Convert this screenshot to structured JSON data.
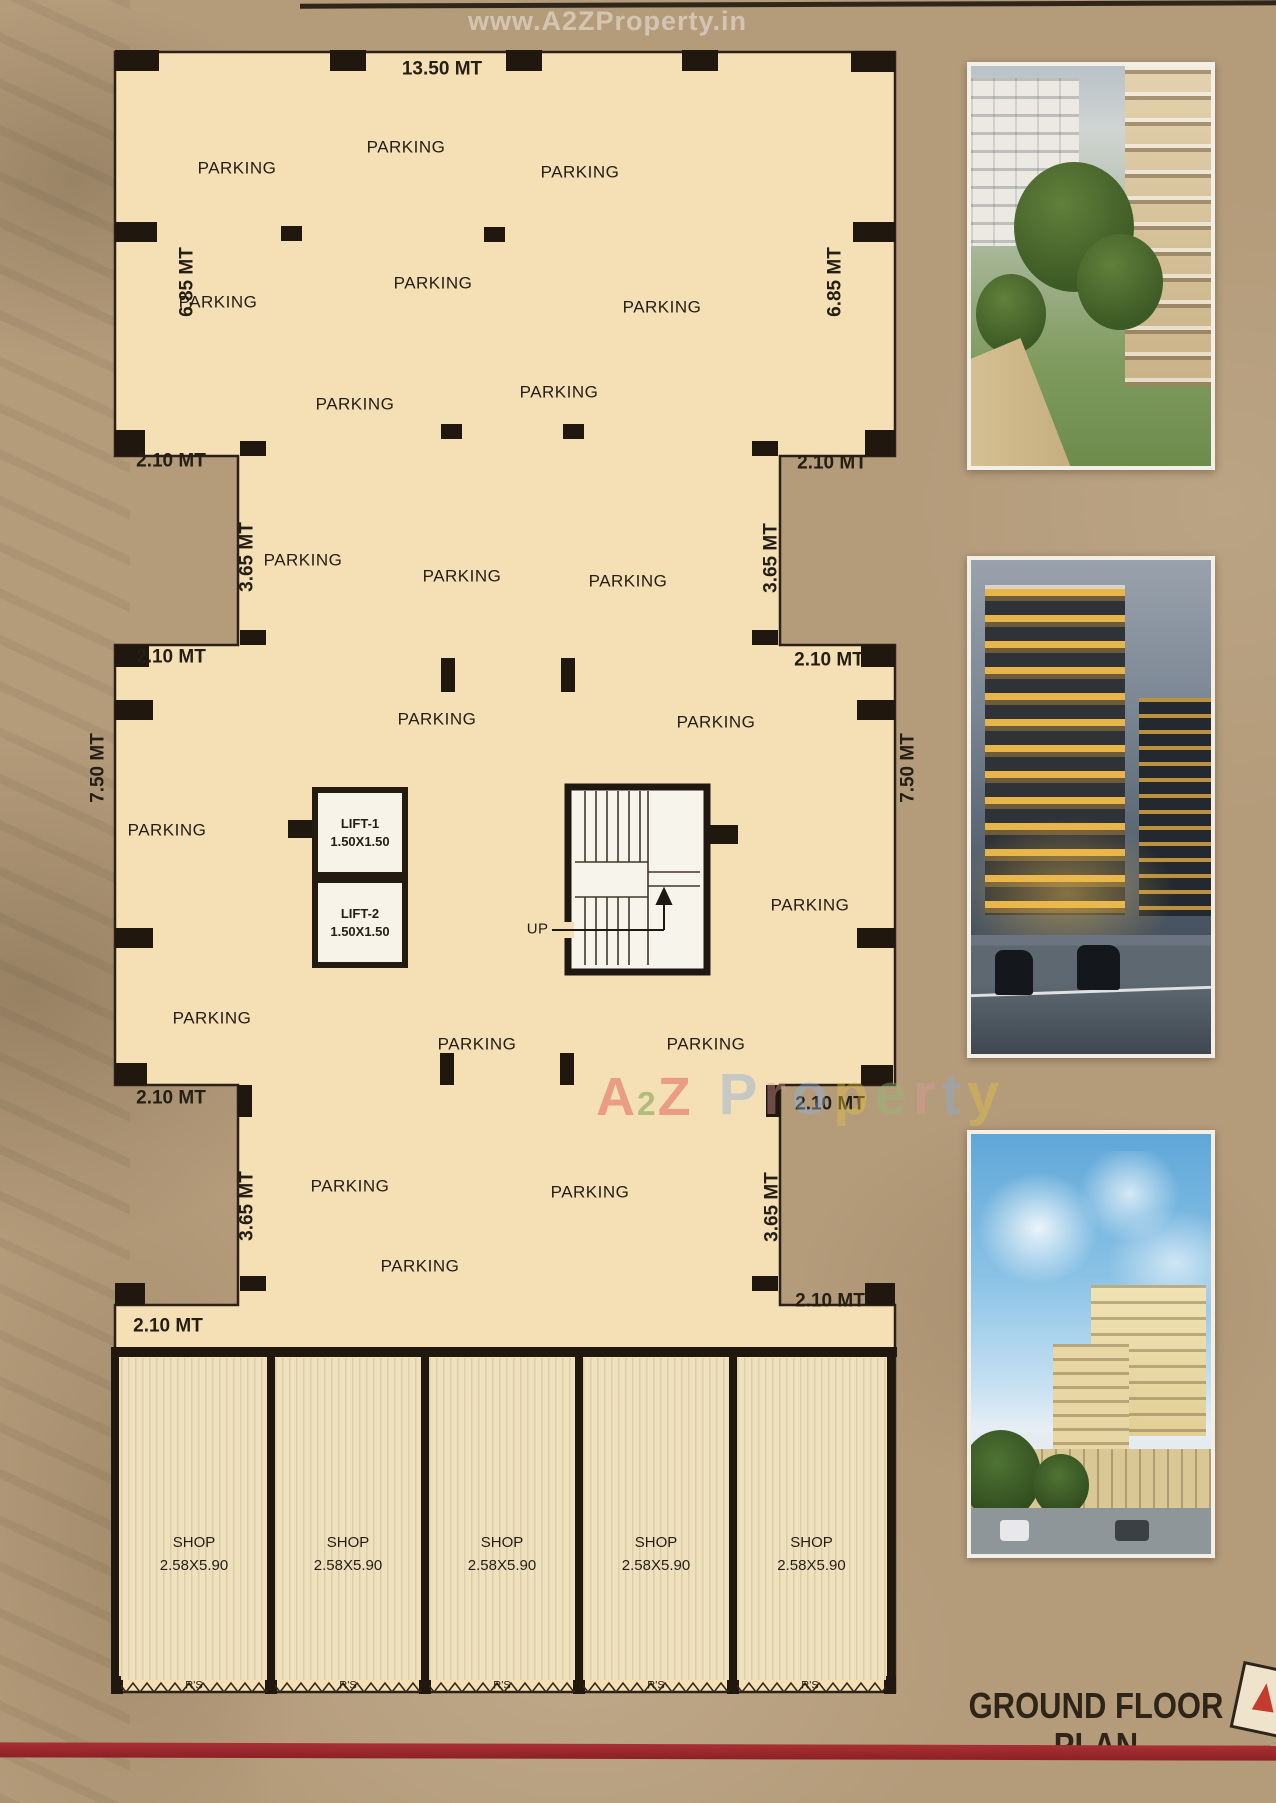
{
  "page": {
    "background": "#b49c7b",
    "accent_red": "#9c2a2d"
  },
  "watermarks": {
    "top_url": "www.A2ZProperty.in",
    "a2z_letters": [
      {
        "ch": "A",
        "color": "#e0685a"
      },
      {
        "ch": "2",
        "color": "#7aa24f",
        "small": true
      },
      {
        "ch": "Z",
        "color": "#e0685a"
      }
    ],
    "property_letters": [
      {
        "ch": "P",
        "color": "#7fa7d8"
      },
      {
        "ch": "r",
        "color": "#e09a9a"
      },
      {
        "ch": "o",
        "color": "#8fb6e0"
      },
      {
        "ch": "p",
        "color": "#e6c33f"
      },
      {
        "ch": "e",
        "color": "#90bd72"
      },
      {
        "ch": "r",
        "color": "#e09a9a"
      },
      {
        "ch": "t",
        "color": "#85abde"
      },
      {
        "ch": "y",
        "color": "#e6c33f"
      }
    ]
  },
  "plan": {
    "parking_label": "PARKING",
    "up_label": "UP",
    "dims": {
      "top_width": "13.50 MT",
      "wing_height": "6.85 MT",
      "step": "2.10 MT",
      "neck": "3.65 MT",
      "mid_height": "7.50 MT"
    },
    "lifts": [
      {
        "name": "LIFT-1",
        "size": "1.50X1.50"
      },
      {
        "name": "LIFT-2",
        "size": "1.50X1.50"
      }
    ],
    "shops": {
      "label": "SHOP",
      "size": "2.58X5.90",
      "shutter_label": "R'S",
      "count": 5
    }
  },
  "footer": {
    "title": "GROUND FLOOR PLAN"
  }
}
